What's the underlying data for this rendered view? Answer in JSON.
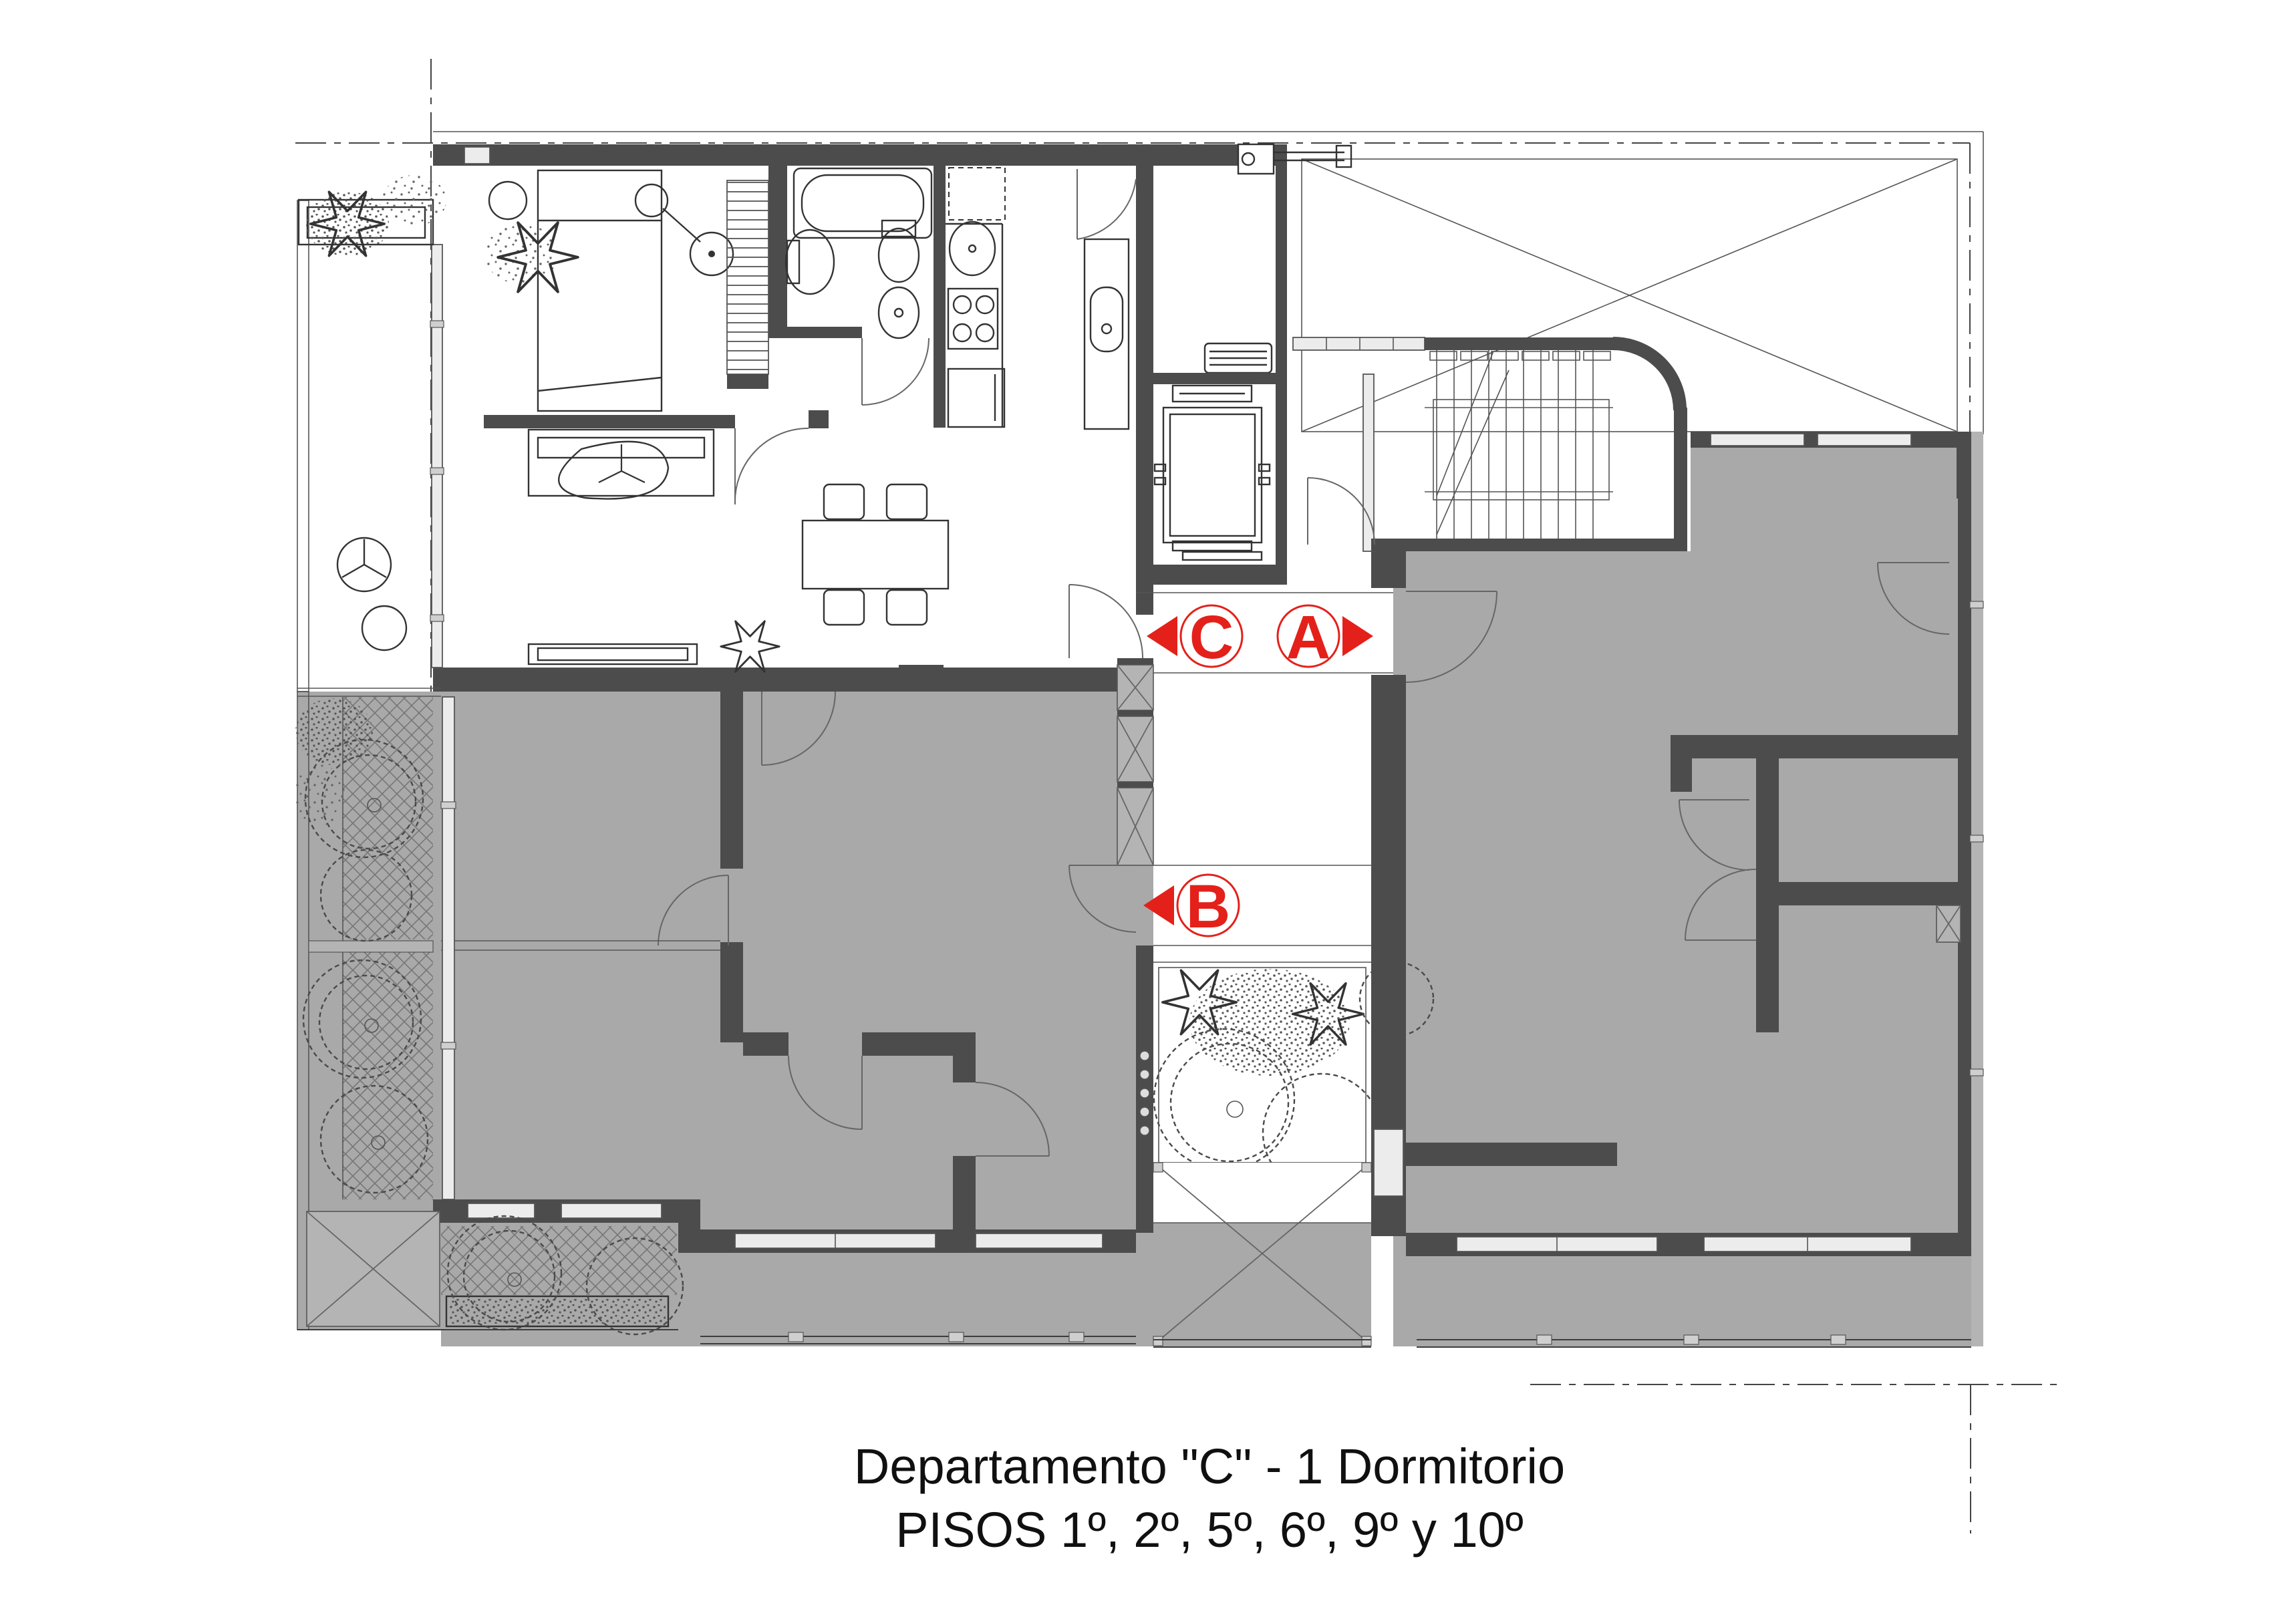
{
  "title": {
    "line1": "Departamento \"C\" - 1 Dormitorio",
    "line2": "PISOS 1º, 2º, 5º, 6º, 9º y 10º"
  },
  "unit": {
    "name": "C",
    "bedrooms": 1,
    "floors": [
      1,
      2,
      5,
      6,
      9,
      10
    ]
  },
  "markers": {
    "unit_c": "C",
    "unit_a": "A",
    "unit_b": "B"
  },
  "colors": {
    "marker_red": "#e3211a",
    "wall_dark": "#4c4c4c",
    "unit_gray": "#a9a9a9",
    "hatch_line": "#767676"
  }
}
